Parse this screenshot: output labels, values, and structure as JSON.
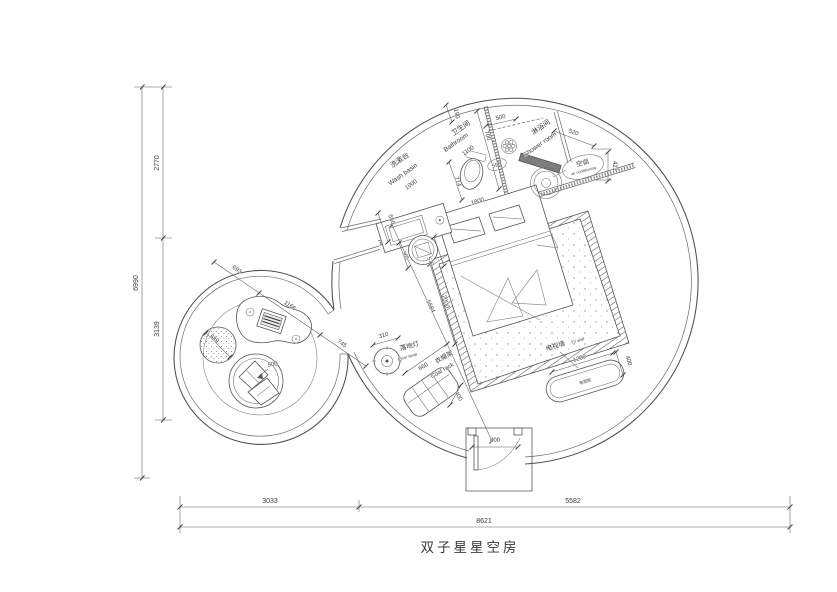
{
  "title": "双子星星空房",
  "labels": {
    "washbasin_cn": "洗漱台",
    "washbasin_en": "Wash basin",
    "bathroom_cn": "卫生间",
    "bathroom_en": "Bathroom",
    "shower_cn": "淋浴间",
    "shower_en": "Shower room",
    "ac_cn": "空调",
    "ac_en": "air conditioning",
    "floor_lamp_cn": "落地灯",
    "floor_lamp_en": "Floor lamp",
    "coat_rack_cn": "衣帽架",
    "coat_rack_en": "Coat rack",
    "tv_wall_cn": "电视墙",
    "tv_wall_en": "TV wall",
    "tv_cabinet": "电视柜"
  },
  "dims": {
    "total_w": "8621",
    "w_left": "3033",
    "w_right": "5582",
    "total_h": "6990",
    "h_top": "2770",
    "h_mid": "3139",
    "d190": "190",
    "d700": "700",
    "d500_shower": "500",
    "d520": "520",
    "d421": "421",
    "d1100": "1100",
    "d1000": "1000",
    "d550": "550",
    "d714": "714",
    "d590": "590",
    "d1800": "1800",
    "d2000": "2000",
    "d5684": "5684",
    "d365": "365",
    "d570": "570",
    "d693": "693",
    "d1166": "1166",
    "d745": "745",
    "d589": "589",
    "d500_chair": "500",
    "d310": "310",
    "d660": "660",
    "d400_rack": "400",
    "d1200": "1200",
    "d400_tv": "400",
    "d800": "800"
  }
}
